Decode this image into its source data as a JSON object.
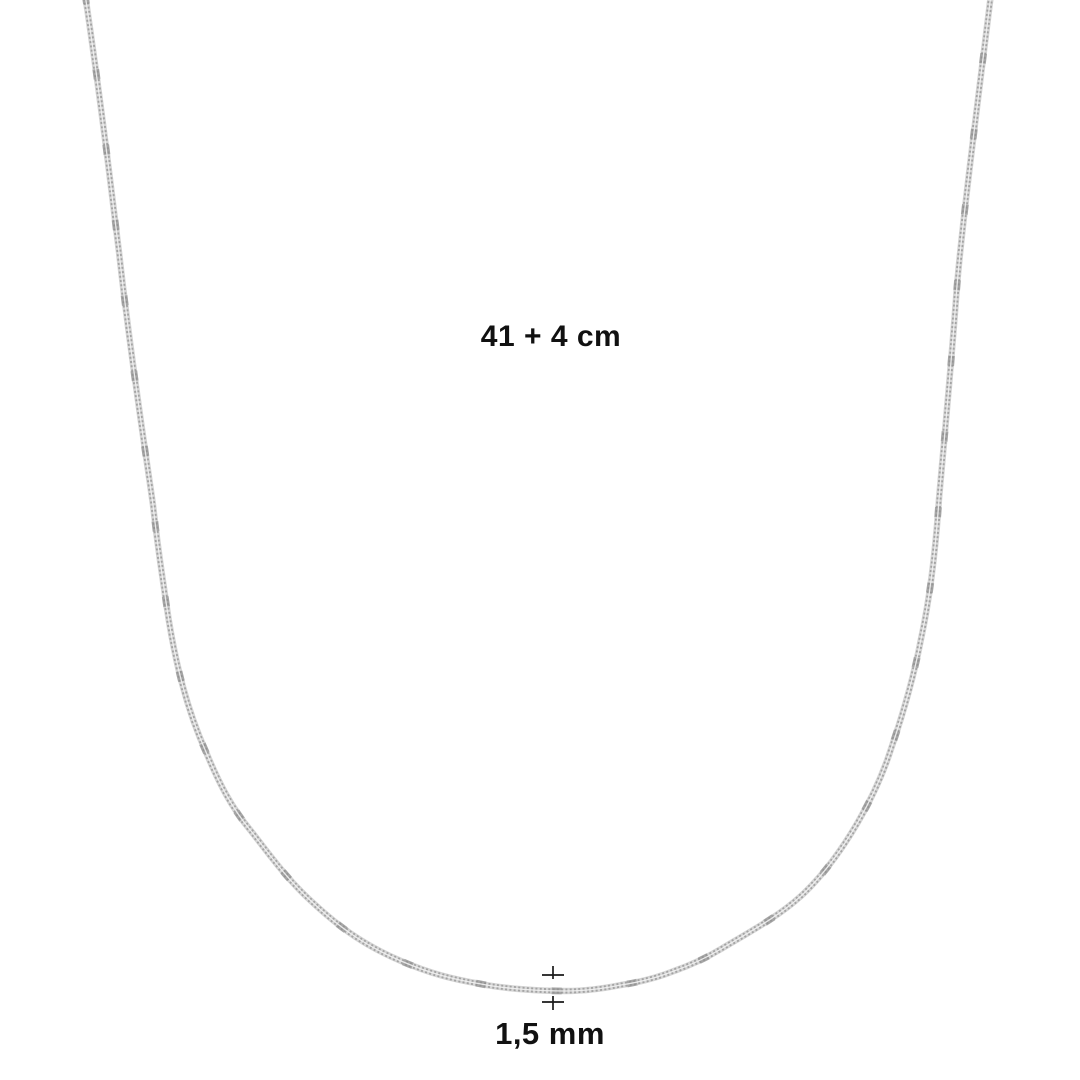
{
  "figure": {
    "name": "necklace-chain",
    "kind": "product-photo"
  },
  "annotations": {
    "length_label": "41 + 4 cm",
    "thickness_label": "1,5 mm"
  },
  "colors": {
    "background": "#ffffff",
    "label_text": "#111111",
    "chain_base": "#d6d6d6",
    "chain_links": "#a3a3a3",
    "chain_accent": "#8c8c8c",
    "chain_highlight": "#f2f2f2",
    "marker": "#1a1a1a"
  }
}
